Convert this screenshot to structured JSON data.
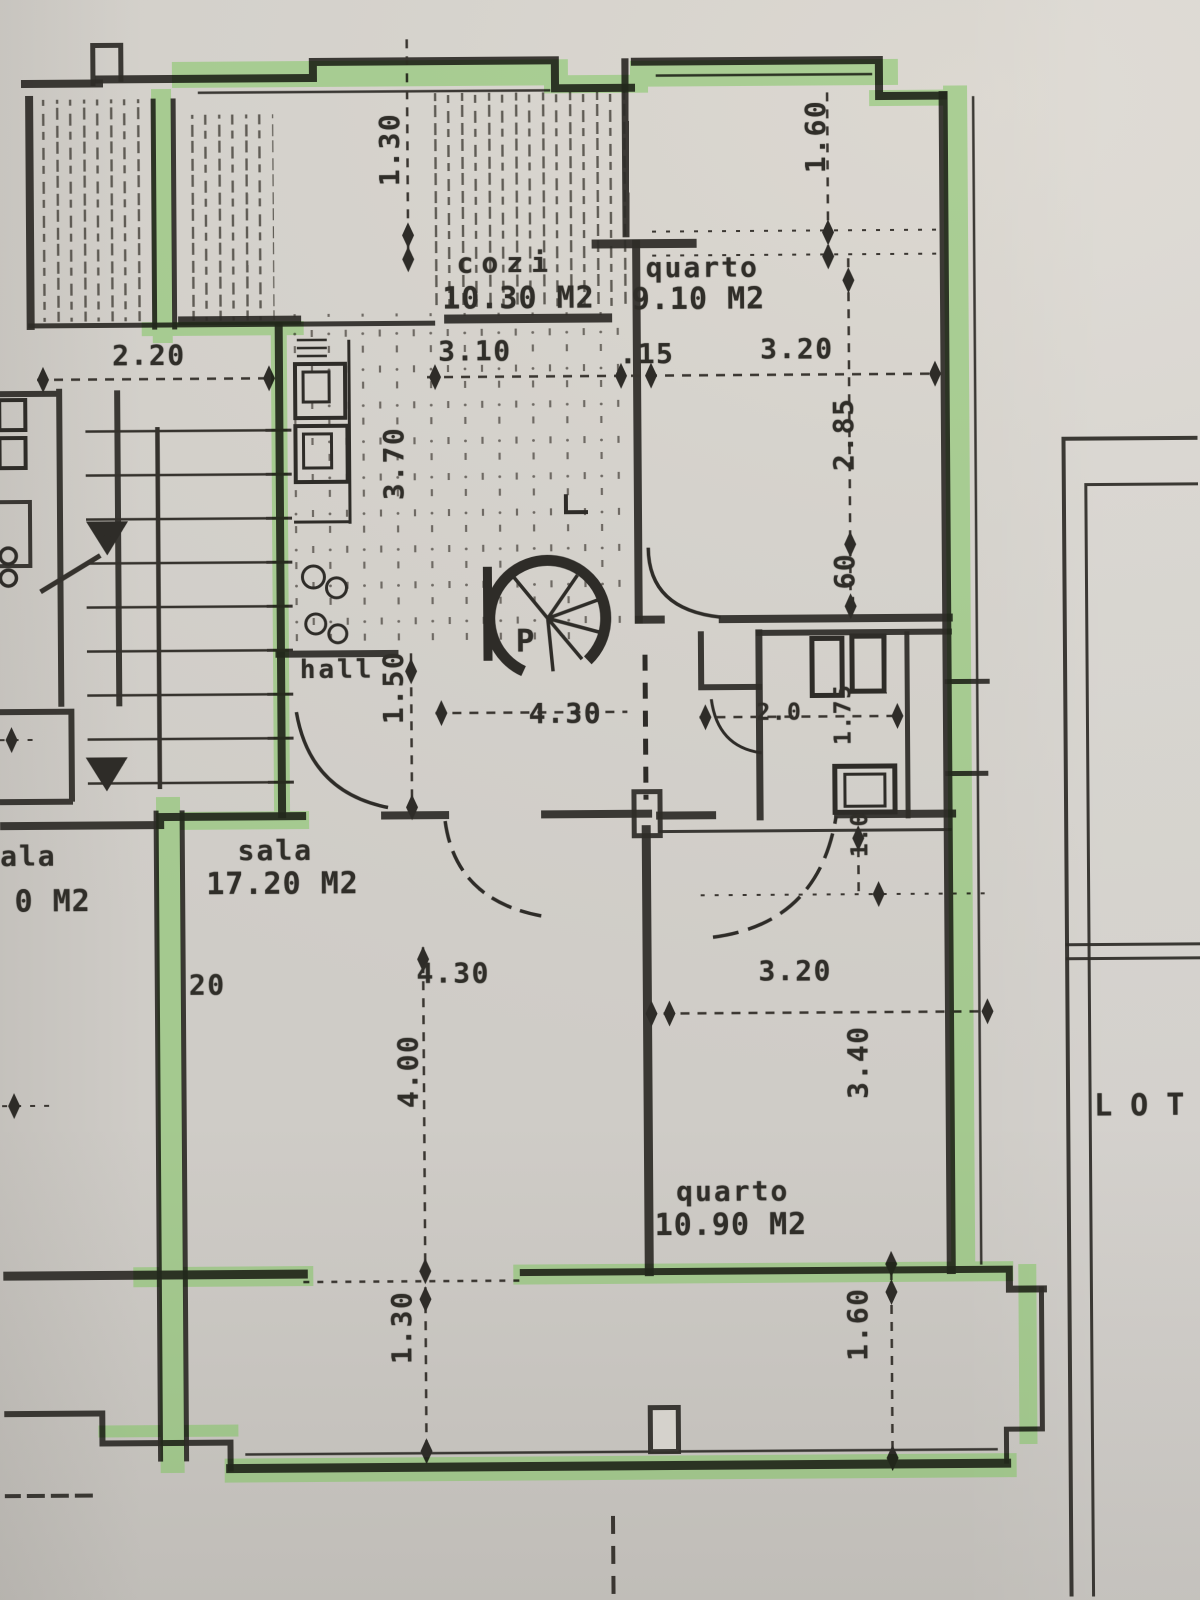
{
  "plan": {
    "rooms": {
      "kitchen": {
        "name": "cozi",
        "area": "10.30 M2"
      },
      "bedroom1": {
        "name": "quarto",
        "area": "9.10 M2"
      },
      "living": {
        "name": "sala",
        "area": "17.20 M2"
      },
      "bedroom2": {
        "name": "quarto",
        "area": "10.90 M2"
      },
      "hall": {
        "name": "hall"
      },
      "neighbor_living": {
        "name": "ala",
        "area": "0 M2"
      },
      "stair": {
        "label": "P"
      }
    },
    "site": {
      "lot_label": "LOTE"
    },
    "dims": {
      "terrace_depth_top": "1.30",
      "terrace_width": "2.20",
      "kitchen_width": "3.10",
      "wall": ".15",
      "bedroom1_width": "3.20",
      "bedroom1_terrace_depth": "1.60",
      "kitchen_depth": "3.70",
      "bedroom1_depth": "2.85",
      "recess": ".60",
      "hall_width": "1.50",
      "corridor_length": "4.30",
      "bath_width": "2.0",
      "bath_length": "1.75",
      "bath_recess": "1.0",
      "living_wall": "20",
      "living_width": "4.30",
      "living_depth": "4.00",
      "bedroom2_width": "3.20",
      "bedroom2_depth": "3.40",
      "balcony_depth_left": "1.30",
      "balcony_depth_right": "1.60"
    },
    "colors": {
      "ink": "#2e2c28",
      "highlighter": "#7dc55b",
      "paper": "#d5d2cc"
    }
  }
}
